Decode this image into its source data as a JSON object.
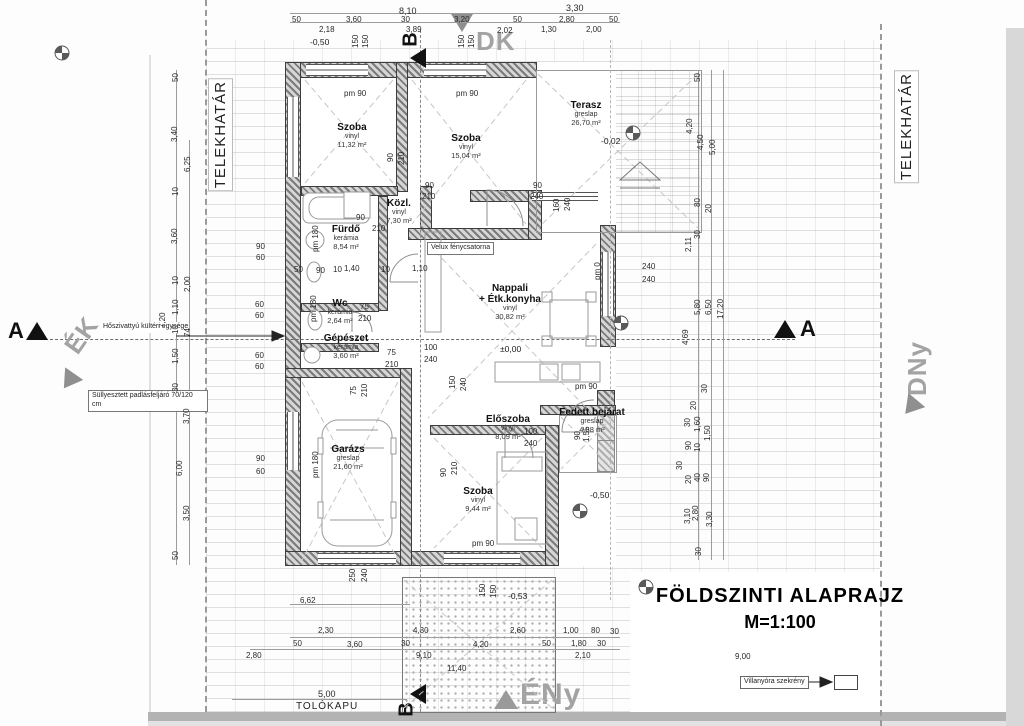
{
  "meta": {
    "title": "FÖLDSZINTI ALAPRAJZ",
    "scale": "M=1:100"
  },
  "boundary": {
    "left": "TELEKHATÁR",
    "right": "TELEKHATÁR"
  },
  "compass": {
    "dk": "DK",
    "dny": "DNy",
    "ek": "ÉK",
    "eny": "ÉNy"
  },
  "sections": {
    "a": "A",
    "b": "B"
  },
  "gate": {
    "label": "TOLÓKAPU",
    "dim": "5,00"
  },
  "annotations": {
    "heat_pump": "Hőszivattyú kültéri egysége",
    "attic": "Süllyesztett padlásfeljáró 70/120 cm",
    "velux": "Velux fénycsatorna",
    "meter": "Villanyóra szekrény"
  },
  "rooms": [
    {
      "name": "Szoba",
      "mat": "vinyl",
      "area": "11,32 m²",
      "x": 352,
      "y": 122
    },
    {
      "name": "Szoba",
      "mat": "vinyl",
      "area": "15,04 m²",
      "x": 466,
      "y": 133
    },
    {
      "name": "Terasz",
      "mat": "greslap",
      "area": "26,70 m²",
      "x": 586,
      "y": 100
    },
    {
      "name": "Közl.",
      "mat": "vinyl",
      "area": "7,30 m²",
      "x": 399,
      "y": 198
    },
    {
      "name": "Fürdő",
      "mat": "kerámia",
      "area": "8,54 m²",
      "x": 346,
      "y": 224
    },
    {
      "name": "Wc",
      "mat": "kerámia",
      "area": "2,64 m²",
      "x": 340,
      "y": 298
    },
    {
      "name": "Gépészet",
      "mat": "kerámia",
      "area": "3,60 m²",
      "x": 346,
      "y": 333
    },
    {
      "name": "Nappali",
      "name2": "+ Étk.konyha",
      "mat": "vinyl",
      "area": "30,82 m²",
      "x": 510,
      "y": 283
    },
    {
      "name": "Garázs",
      "mat": "greslap",
      "area": "21,60 m²",
      "x": 348,
      "y": 444
    },
    {
      "name": "Előszoba",
      "mat": "vinyl",
      "area": "8,09 m²",
      "x": 508,
      "y": 414
    },
    {
      "name": "Szoba",
      "mat": "vinyl",
      "area": "9,44 m²",
      "x": 478,
      "y": 486
    },
    {
      "name": "Fedett bejárat",
      "mat": "greslap",
      "area": "4,88 m²",
      "x": 592,
      "y": 407
    }
  ],
  "levels": [
    {
      "t": "-0,50",
      "x": 310,
      "y": 37
    },
    {
      "t": "-0,02",
      "x": 601,
      "y": 136
    },
    {
      "t": "±0,00",
      "x": 500,
      "y": 344
    },
    {
      "t": "-0,50",
      "x": 590,
      "y": 490
    },
    {
      "t": "-0,53",
      "x": 508,
      "y": 591
    }
  ],
  "dims": [
    {
      "t": "8,10",
      "x": 399,
      "y": 7,
      "big": 1
    },
    {
      "t": "3,30",
      "x": 566,
      "y": 4,
      "big": 1
    },
    {
      "t": "50",
      "x": 292,
      "y": 16
    },
    {
      "t": "3,60",
      "x": 346,
      "y": 16
    },
    {
      "t": "30",
      "x": 401,
      "y": 16
    },
    {
      "t": "3,20",
      "x": 454,
      "y": 16
    },
    {
      "t": "50",
      "x": 513,
      "y": 16
    },
    {
      "t": "2,80",
      "x": 559,
      "y": 16
    },
    {
      "t": "50",
      "x": 609,
      "y": 16
    },
    {
      "t": "2,18",
      "x": 319,
      "y": 26
    },
    {
      "t": "3,89",
      "x": 406,
      "y": 26
    },
    {
      "t": "2,02",
      "x": 497,
      "y": 27
    },
    {
      "t": "1,30",
      "x": 541,
      "y": 26
    },
    {
      "t": "2,00",
      "x": 586,
      "y": 26
    },
    {
      "t": "150",
      "x": 352,
      "y": 48,
      "r": 1
    },
    {
      "t": "150",
      "x": 362,
      "y": 48,
      "r": 1
    },
    {
      "t": "150",
      "x": 458,
      "y": 48,
      "r": 1
    },
    {
      "t": "150",
      "x": 468,
      "y": 48,
      "r": 1
    },
    {
      "t": "50",
      "x": 172,
      "y": 82,
      "r": 1
    },
    {
      "t": "3,40",
      "x": 171,
      "y": 142,
      "r": 1
    },
    {
      "t": "6,25",
      "x": 184,
      "y": 172,
      "r": 1
    },
    {
      "t": "10",
      "x": 172,
      "y": 196,
      "r": 1
    },
    {
      "t": "3,60",
      "x": 171,
      "y": 244,
      "r": 1
    },
    {
      "t": "10",
      "x": 172,
      "y": 285,
      "r": 1
    },
    {
      "t": "2,00",
      "x": 184,
      "y": 292,
      "r": 1
    },
    {
      "t": "1,10",
      "x": 172,
      "y": 315,
      "r": 1
    },
    {
      "t": "7,20",
      "x": 159,
      "y": 328,
      "r": 1
    },
    {
      "t": "10",
      "x": 172,
      "y": 334,
      "r": 1
    },
    {
      "t": "74",
      "x": 184,
      "y": 337,
      "r": 1
    },
    {
      "t": "1,50",
      "x": 172,
      "y": 364,
      "r": 1
    },
    {
      "t": "30",
      "x": 172,
      "y": 392,
      "r": 1
    },
    {
      "t": "3,70",
      "x": 183,
      "y": 424,
      "r": 1
    },
    {
      "t": "6,00",
      "x": 176,
      "y": 476,
      "r": 1
    },
    {
      "t": "3,50",
      "x": 183,
      "y": 521,
      "r": 1
    },
    {
      "t": "50",
      "x": 172,
      "y": 560,
      "r": 1
    },
    {
      "t": "90",
      "x": 256,
      "y": 243
    },
    {
      "t": "60",
      "x": 256,
      "y": 254
    },
    {
      "t": "60",
      "x": 255,
      "y": 301
    },
    {
      "t": "60",
      "x": 255,
      "y": 312
    },
    {
      "t": "60",
      "x": 255,
      "y": 352
    },
    {
      "t": "60",
      "x": 255,
      "y": 363
    },
    {
      "t": "90",
      "x": 256,
      "y": 455
    },
    {
      "t": "60",
      "x": 256,
      "y": 468
    },
    {
      "t": "50",
      "x": 694,
      "y": 82,
      "r": 1
    },
    {
      "t": "4,20",
      "x": 686,
      "y": 134,
      "r": 1
    },
    {
      "t": "4,50",
      "x": 697,
      "y": 150,
      "r": 1
    },
    {
      "t": "5,00",
      "x": 709,
      "y": 155,
      "r": 1
    },
    {
      "t": "80",
      "x": 694,
      "y": 207,
      "r": 1
    },
    {
      "t": "20",
      "x": 705,
      "y": 213,
      "r": 1
    },
    {
      "t": "30",
      "x": 694,
      "y": 239,
      "r": 1
    },
    {
      "t": "2,11",
      "x": 685,
      "y": 252,
      "r": 1
    },
    {
      "t": "5,80",
      "x": 694,
      "y": 315,
      "r": 1
    },
    {
      "t": "6,50",
      "x": 705,
      "y": 315,
      "r": 1
    },
    {
      "t": "17,20",
      "x": 717,
      "y": 319,
      "r": 1
    },
    {
      "t": "4,69",
      "x": 682,
      "y": 345,
      "r": 1
    },
    {
      "t": "30",
      "x": 701,
      "y": 393,
      "r": 1
    },
    {
      "t": "20",
      "x": 690,
      "y": 410,
      "r": 1
    },
    {
      "t": "30",
      "x": 684,
      "y": 427,
      "r": 1
    },
    {
      "t": "1,60",
      "x": 694,
      "y": 432,
      "r": 1
    },
    {
      "t": "1,50",
      "x": 704,
      "y": 441,
      "r": 1
    },
    {
      "t": "90",
      "x": 685,
      "y": 450,
      "r": 1
    },
    {
      "t": "10",
      "x": 694,
      "y": 452,
      "r": 1
    },
    {
      "t": "30",
      "x": 676,
      "y": 470,
      "r": 1
    },
    {
      "t": "20",
      "x": 685,
      "y": 484,
      "r": 1
    },
    {
      "t": "40",
      "x": 694,
      "y": 482,
      "r": 1
    },
    {
      "t": "90",
      "x": 703,
      "y": 482,
      "r": 1
    },
    {
      "t": "3,10",
      "x": 684,
      "y": 524,
      "r": 1
    },
    {
      "t": "2,80",
      "x": 692,
      "y": 521,
      "r": 1
    },
    {
      "t": "3,30",
      "x": 706,
      "y": 527,
      "r": 1
    },
    {
      "t": "30",
      "x": 695,
      "y": 556,
      "r": 1
    },
    {
      "t": "pm 90",
      "x": 344,
      "y": 90
    },
    {
      "t": "pm 90",
      "x": 456,
      "y": 90
    },
    {
      "t": "90",
      "x": 387,
      "y": 162,
      "r": 1
    },
    {
      "t": "210",
      "x": 398,
      "y": 165,
      "r": 1
    },
    {
      "t": "90",
      "x": 425,
      "y": 182
    },
    {
      "t": "210",
      "x": 422,
      "y": 193
    },
    {
      "t": "90",
      "x": 533,
      "y": 182
    },
    {
      "t": "240",
      "x": 530,
      "y": 193
    },
    {
      "t": "160",
      "x": 553,
      "y": 212,
      "r": 1
    },
    {
      "t": "240",
      "x": 564,
      "y": 211,
      "r": 1
    },
    {
      "t": "pm 180",
      "x": 312,
      "y": 252,
      "r": 1
    },
    {
      "t": "90",
      "x": 356,
      "y": 214
    },
    {
      "t": "210",
      "x": 372,
      "y": 225
    },
    {
      "t": "50",
      "x": 294,
      "y": 266
    },
    {
      "t": "90",
      "x": 316,
      "y": 267
    },
    {
      "t": "10",
      "x": 333,
      "y": 266
    },
    {
      "t": "1,40",
      "x": 344,
      "y": 265
    },
    {
      "t": "10",
      "x": 381,
      "y": 266
    },
    {
      "t": "1,10",
      "x": 412,
      "y": 265
    },
    {
      "t": "75",
      "x": 360,
      "y": 303
    },
    {
      "t": "210",
      "x": 358,
      "y": 315
    },
    {
      "t": "pm 180",
      "x": 310,
      "y": 322,
      "r": 1
    },
    {
      "t": "75",
      "x": 387,
      "y": 349
    },
    {
      "t": "210",
      "x": 385,
      "y": 361
    },
    {
      "t": "100",
      "x": 424,
      "y": 344
    },
    {
      "t": "240",
      "x": 424,
      "y": 356
    },
    {
      "t": "75",
      "x": 350,
      "y": 395,
      "r": 1
    },
    {
      "t": "210",
      "x": 361,
      "y": 397,
      "r": 1
    },
    {
      "t": "pm 180",
      "x": 312,
      "y": 478,
      "r": 1
    },
    {
      "t": "150",
      "x": 449,
      "y": 389,
      "r": 1
    },
    {
      "t": "240",
      "x": 460,
      "y": 391,
      "r": 1
    },
    {
      "t": "pm 0",
      "x": 594,
      "y": 280,
      "r": 1
    },
    {
      "t": "240",
      "x": 642,
      "y": 263
    },
    {
      "t": "240",
      "x": 642,
      "y": 276
    },
    {
      "t": "pm 90",
      "x": 575,
      "y": 383
    },
    {
      "t": "100",
      "x": 524,
      "y": 428
    },
    {
      "t": "240",
      "x": 524,
      "y": 440
    },
    {
      "t": "90",
      "x": 440,
      "y": 477,
      "r": 1
    },
    {
      "t": "210",
      "x": 451,
      "y": 475,
      "r": 1
    },
    {
      "t": "90",
      "x": 574,
      "y": 440,
      "r": 1
    },
    {
      "t": "1,55",
      "x": 583,
      "y": 442,
      "r": 1
    },
    {
      "t": "pm 90",
      "x": 472,
      "y": 540
    },
    {
      "t": "250",
      "x": 349,
      "y": 582,
      "r": 1
    },
    {
      "t": "240",
      "x": 361,
      "y": 582,
      "r": 1
    },
    {
      "t": "6,62",
      "x": 300,
      "y": 597
    },
    {
      "t": "150",
      "x": 479,
      "y": 597,
      "r": 1
    },
    {
      "t": "150",
      "x": 490,
      "y": 598,
      "r": 1
    },
    {
      "t": "2,30",
      "x": 318,
      "y": 627
    },
    {
      "t": "4,30",
      "x": 413,
      "y": 627
    },
    {
      "t": "2,60",
      "x": 510,
      "y": 627
    },
    {
      "t": "1,00",
      "x": 563,
      "y": 627
    },
    {
      "t": "80",
      "x": 591,
      "y": 627
    },
    {
      "t": "30",
      "x": 610,
      "y": 628
    },
    {
      "t": "50",
      "x": 293,
      "y": 640
    },
    {
      "t": "3,60",
      "x": 347,
      "y": 641
    },
    {
      "t": "30",
      "x": 401,
      "y": 640
    },
    {
      "t": "4,20",
      "x": 473,
      "y": 641
    },
    {
      "t": "50",
      "x": 542,
      "y": 640
    },
    {
      "t": "1,80",
      "x": 571,
      "y": 640
    },
    {
      "t": "30",
      "x": 597,
      "y": 640
    },
    {
      "t": "2,80",
      "x": 246,
      "y": 652
    },
    {
      "t": "9,10",
      "x": 416,
      "y": 652
    },
    {
      "t": "2,10",
      "x": 575,
      "y": 652
    },
    {
      "t": "11,40",
      "x": 447,
      "y": 665
    },
    {
      "t": "9,00",
      "x": 735,
      "y": 653
    }
  ]
}
